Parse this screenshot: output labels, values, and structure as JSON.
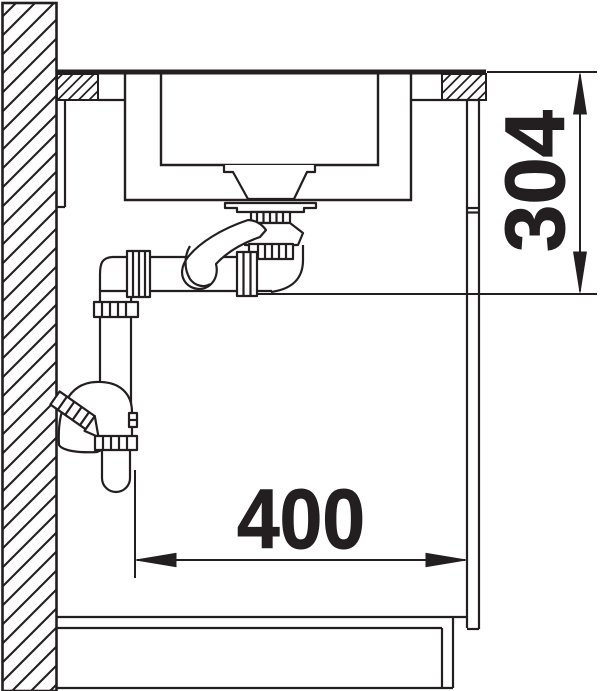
{
  "diagram": {
    "kind": "sink-installation-section-drawing",
    "background": "#ffffff",
    "line_color": "#231f20",
    "dimensions": [
      {
        "value": "304",
        "orientation": "vertical",
        "position": "right-side"
      },
      {
        "value": "400",
        "orientation": "horizontal",
        "position": "bottom"
      }
    ]
  }
}
